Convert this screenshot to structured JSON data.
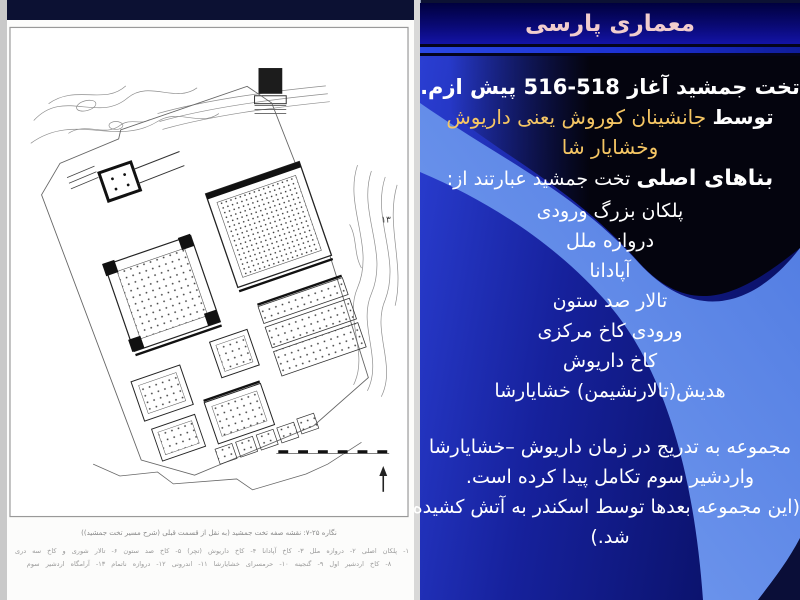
{
  "title": "معماری  پارسی",
  "slide": {
    "heading_line1": "تخت جمشید آغاز 518-516 پیش ازم.",
    "bold_prefix": "توسط",
    "heading_line2_rest": " جانشینان کوروش یعنی داریوش",
    "heading_line3": "وخشایار شا",
    "buildings_intro_bold": "بناهای اصلی",
    "buildings_intro_rest": " تخت جمشید عبارتند از:",
    "buildings": [
      "پلکان بزرگ ورودی",
      "دروازه ملل",
      "آپادانا",
      "تالار صد ستون",
      "ورودی کاخ مرکزی",
      "کاخ داریوش",
      "هدیش(تالارنشیمن) خشایارشا"
    ],
    "paragraph_lines": [
      "مجموعه به تدریج در زمان داریوش –خشایارشا",
      "واردشیر سوم تکامل پیدا کرده است.",
      "(این مجموعه بعدها توسط اسکندر به آتش کشیده",
      "شد.)"
    ]
  },
  "figure": {
    "caption": "نگاره ۲۵-۷: نقشه صفه تخت جمشید (به نقل از قسمت قبلی (شرح مسیر تخت جمشید))",
    "legend_line1": "۱- پلکان اصلی ۲- دروازه ملل ۳- کاخ آپادانا ۴- کاخ داریوش (تچر) ۵- کاخ صد ستون ۶- تالار شوری و کاخ سه دری ۷- کاخ خشایارشا با هدیش",
    "legend_line2": "۸- کاخ اردشیر اول ۹- گنجینه ۱۰- حرمسرای خشایارشا ۱۱- اندرونی ۱۲- دروازه ناتمام ۱۳- آرامگاه اردشیر سوم",
    "map_label_13": "۱۳"
  },
  "colors": {
    "accent_gold": "#f5c664",
    "title_pink": "#f1cdcd",
    "swoosh_blue": "#5b87e8",
    "panel_blue": "#1b2aa8"
  }
}
